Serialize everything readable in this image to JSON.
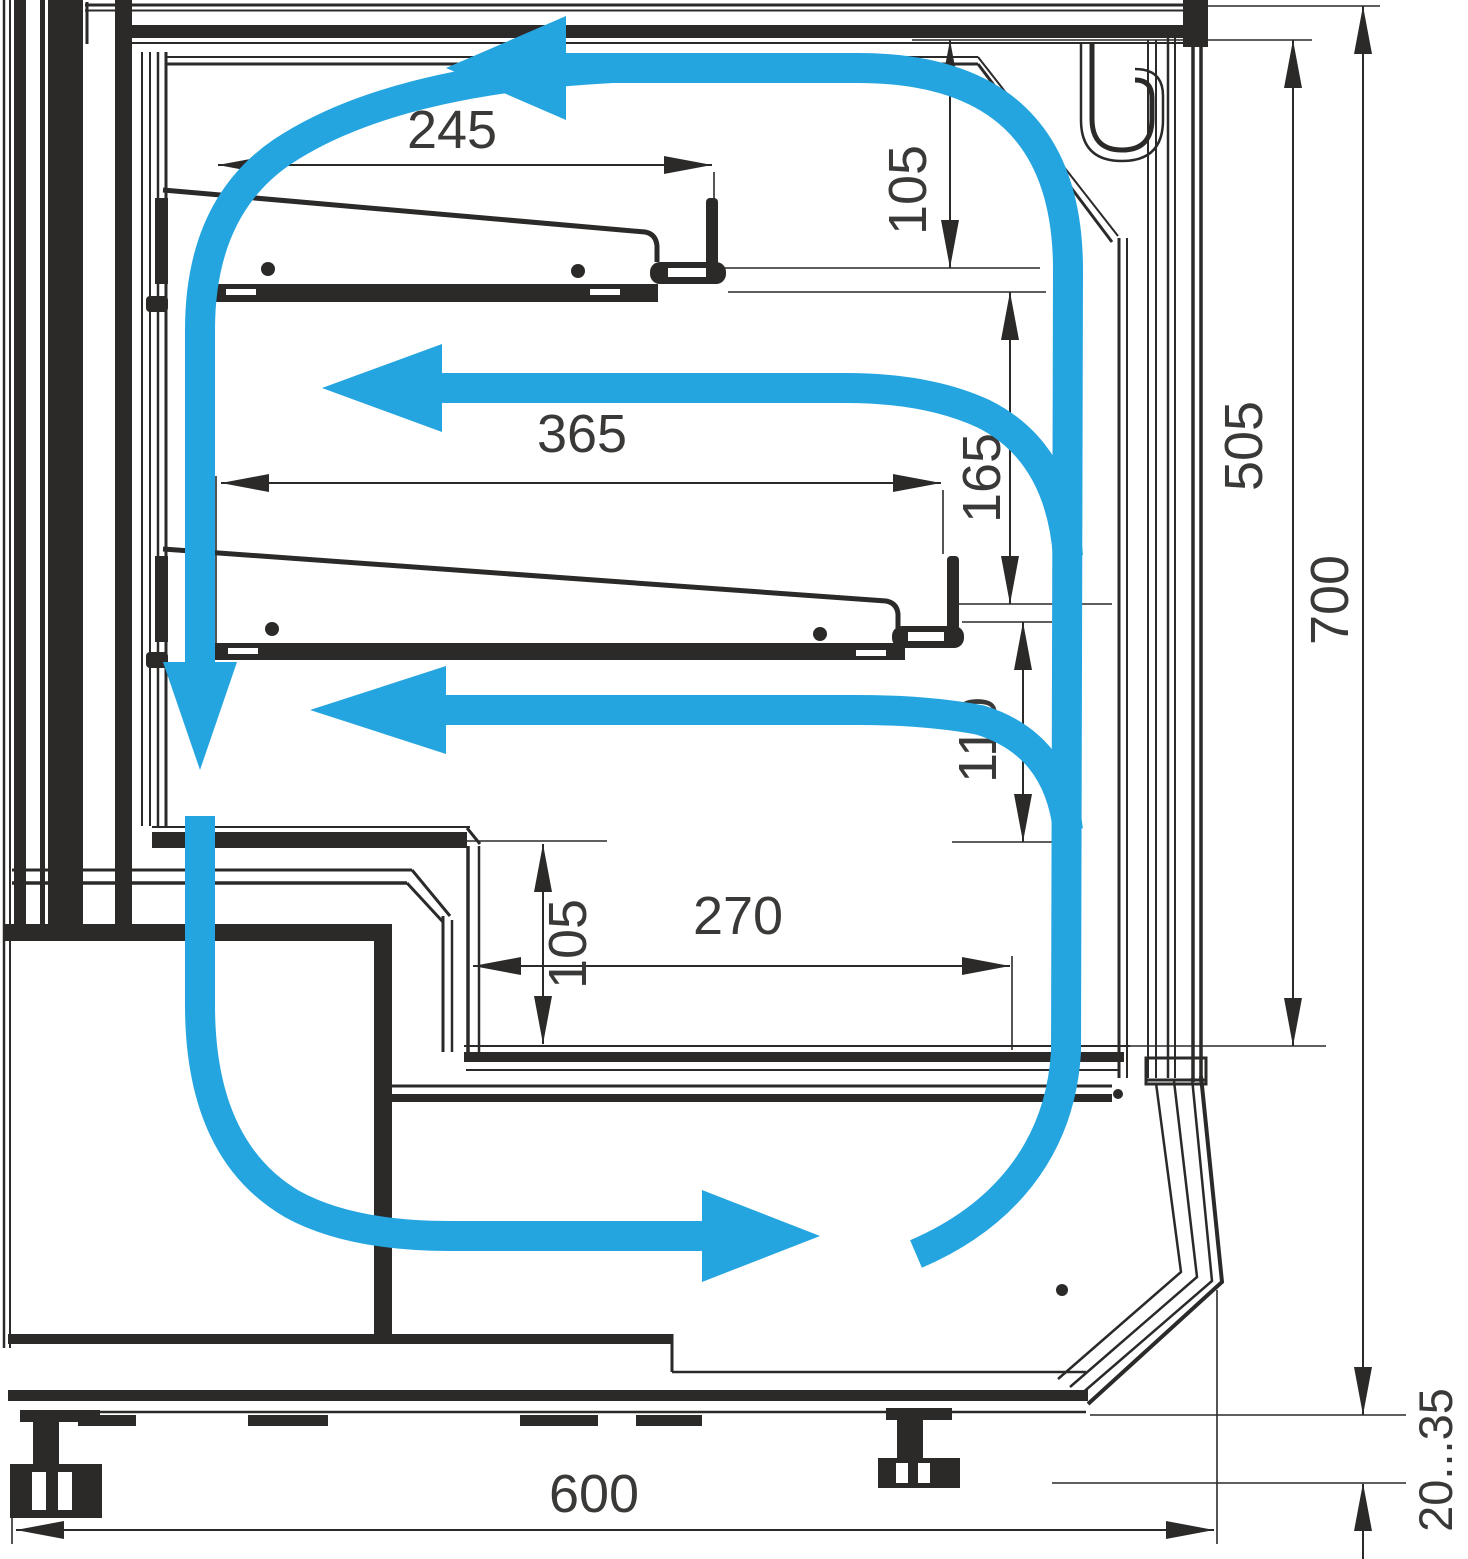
{
  "diagram": {
    "title": "Refrigerated display case cross-section with air circulation",
    "units": "mm",
    "colors": {
      "line": "#2B2A29",
      "label": "#3A3937",
      "airflow": "#25A5E0",
      "background": "#FFFFFF"
    },
    "dimensions": [
      {
        "label": "245",
        "orientation": "horizontal",
        "measures": "upper shelf depth"
      },
      {
        "label": "365",
        "orientation": "horizontal",
        "measures": "middle shelf depth"
      },
      {
        "label": "270",
        "orientation": "horizontal",
        "measures": "lower deck depth"
      },
      {
        "label": "105",
        "orientation": "vertical",
        "measures": "clearance above upper shelf"
      },
      {
        "label": "165",
        "orientation": "vertical",
        "measures": "clearance between shelves"
      },
      {
        "label": "110",
        "orientation": "vertical",
        "measures": "clearance below middle shelf"
      },
      {
        "label": "105",
        "orientation": "vertical",
        "measures": "well depth at counter step"
      },
      {
        "label": "505",
        "orientation": "vertical",
        "measures": "display opening height"
      },
      {
        "label": "700",
        "orientation": "vertical",
        "measures": "overall height above base plane"
      },
      {
        "label": "600",
        "orientation": "horizontal",
        "measures": "overall depth"
      },
      {
        "label": "20...35",
        "orientation": "vertical",
        "measures": "adjustable foot height range"
      }
    ],
    "airflow": {
      "color": "#25A5E0",
      "loop": "air rises along the front glass, crosses the top to the rear, descends the rear duct and returns along the base",
      "arrows": [
        {
          "direction": "left",
          "location": "top interior"
        },
        {
          "direction": "left",
          "location": "above middle shelf"
        },
        {
          "direction": "left",
          "location": "below middle shelf"
        },
        {
          "direction": "down",
          "location": "rear air duct"
        },
        {
          "direction": "right",
          "location": "base air outlet"
        }
      ]
    }
  }
}
